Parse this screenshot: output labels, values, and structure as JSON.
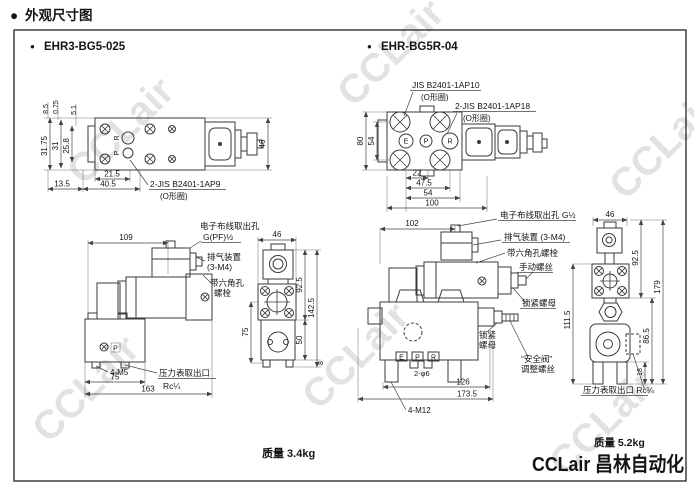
{
  "page": {
    "bullet": "●",
    "title": "外观尺寸图",
    "watermark": "CCLair",
    "logo": "CCLair 昌林自动化"
  },
  "left": {
    "model": "EHR3-BG5-025",
    "mass": "质量 3.4kg",
    "top": {
      "oring": "2-JIS B2401-1AP9",
      "oring_note": "(O形圈)",
      "port_r": "R",
      "port_p": "P",
      "d_3175": "31.75",
      "d_31": "31",
      "d_258": "25.8",
      "d_85": "8.5",
      "d_075": "0.75",
      "d_51": "5.1",
      "d_215": "21.5",
      "d_135": "13.5",
      "d_405": "40.5",
      "d_46": "46"
    },
    "front": {
      "d_109": "109",
      "wiring1": "电子布线取出孔",
      "wiring2": "G(PF)½",
      "bleed1": "排气装置",
      "bleed2": "(3-M4)",
      "hex1": "带六角孔",
      "hex2": "螺栓",
      "port_p": "P",
      "bolts": "4-M5",
      "d_75": "75",
      "d_163": "163",
      "gauge1": "压力表取出口",
      "gauge2": "Rc¼"
    },
    "side": {
      "d_46": "46",
      "d_925": "92.5",
      "d_1425": "142.5",
      "d_50": "50",
      "d_8": "8",
      "d_75": "75"
    }
  },
  "right": {
    "model": "EHR-BG5R-04",
    "mass": "质量 5.2kg",
    "top": {
      "oring1": "JIS B2401-1AP10",
      "oring1_note": "(O形圈)",
      "oring2": "2-JIS B2401-1AP18",
      "oring2_note": "(O形圈)",
      "port_e": "E",
      "port_p": "P",
      "port_r": "R",
      "d_80": "80",
      "d_54": "54",
      "d_22": "22",
      "d_475": "47.5",
      "d_54b": "54",
      "d_100": "100"
    },
    "front": {
      "d_102": "102",
      "wiring": "电子布线取出孔 G½",
      "bleed": "排气装置 (3-M4)",
      "hex": "带六角孔螺栓",
      "manual": "手动螺丝",
      "locknut": "锁紧螺母",
      "locknut2a": "锁紧",
      "locknut2b": "螺母",
      "safety1": "“安全阀”",
      "safety2": "调整螺丝",
      "port_e": "E",
      "port_p": "P",
      "port_r": "R",
      "d_holes": "2-φ6",
      "d_126": "126",
      "d_1735": "173.5",
      "bolts": "4-M12"
    },
    "side": {
      "d_46": "46",
      "d_925": "92.5",
      "d_179": "179",
      "d_865": "86.5",
      "d_1115": "111.5",
      "d_18": "18",
      "gauge": "压力表取出口 Rc¼"
    }
  }
}
